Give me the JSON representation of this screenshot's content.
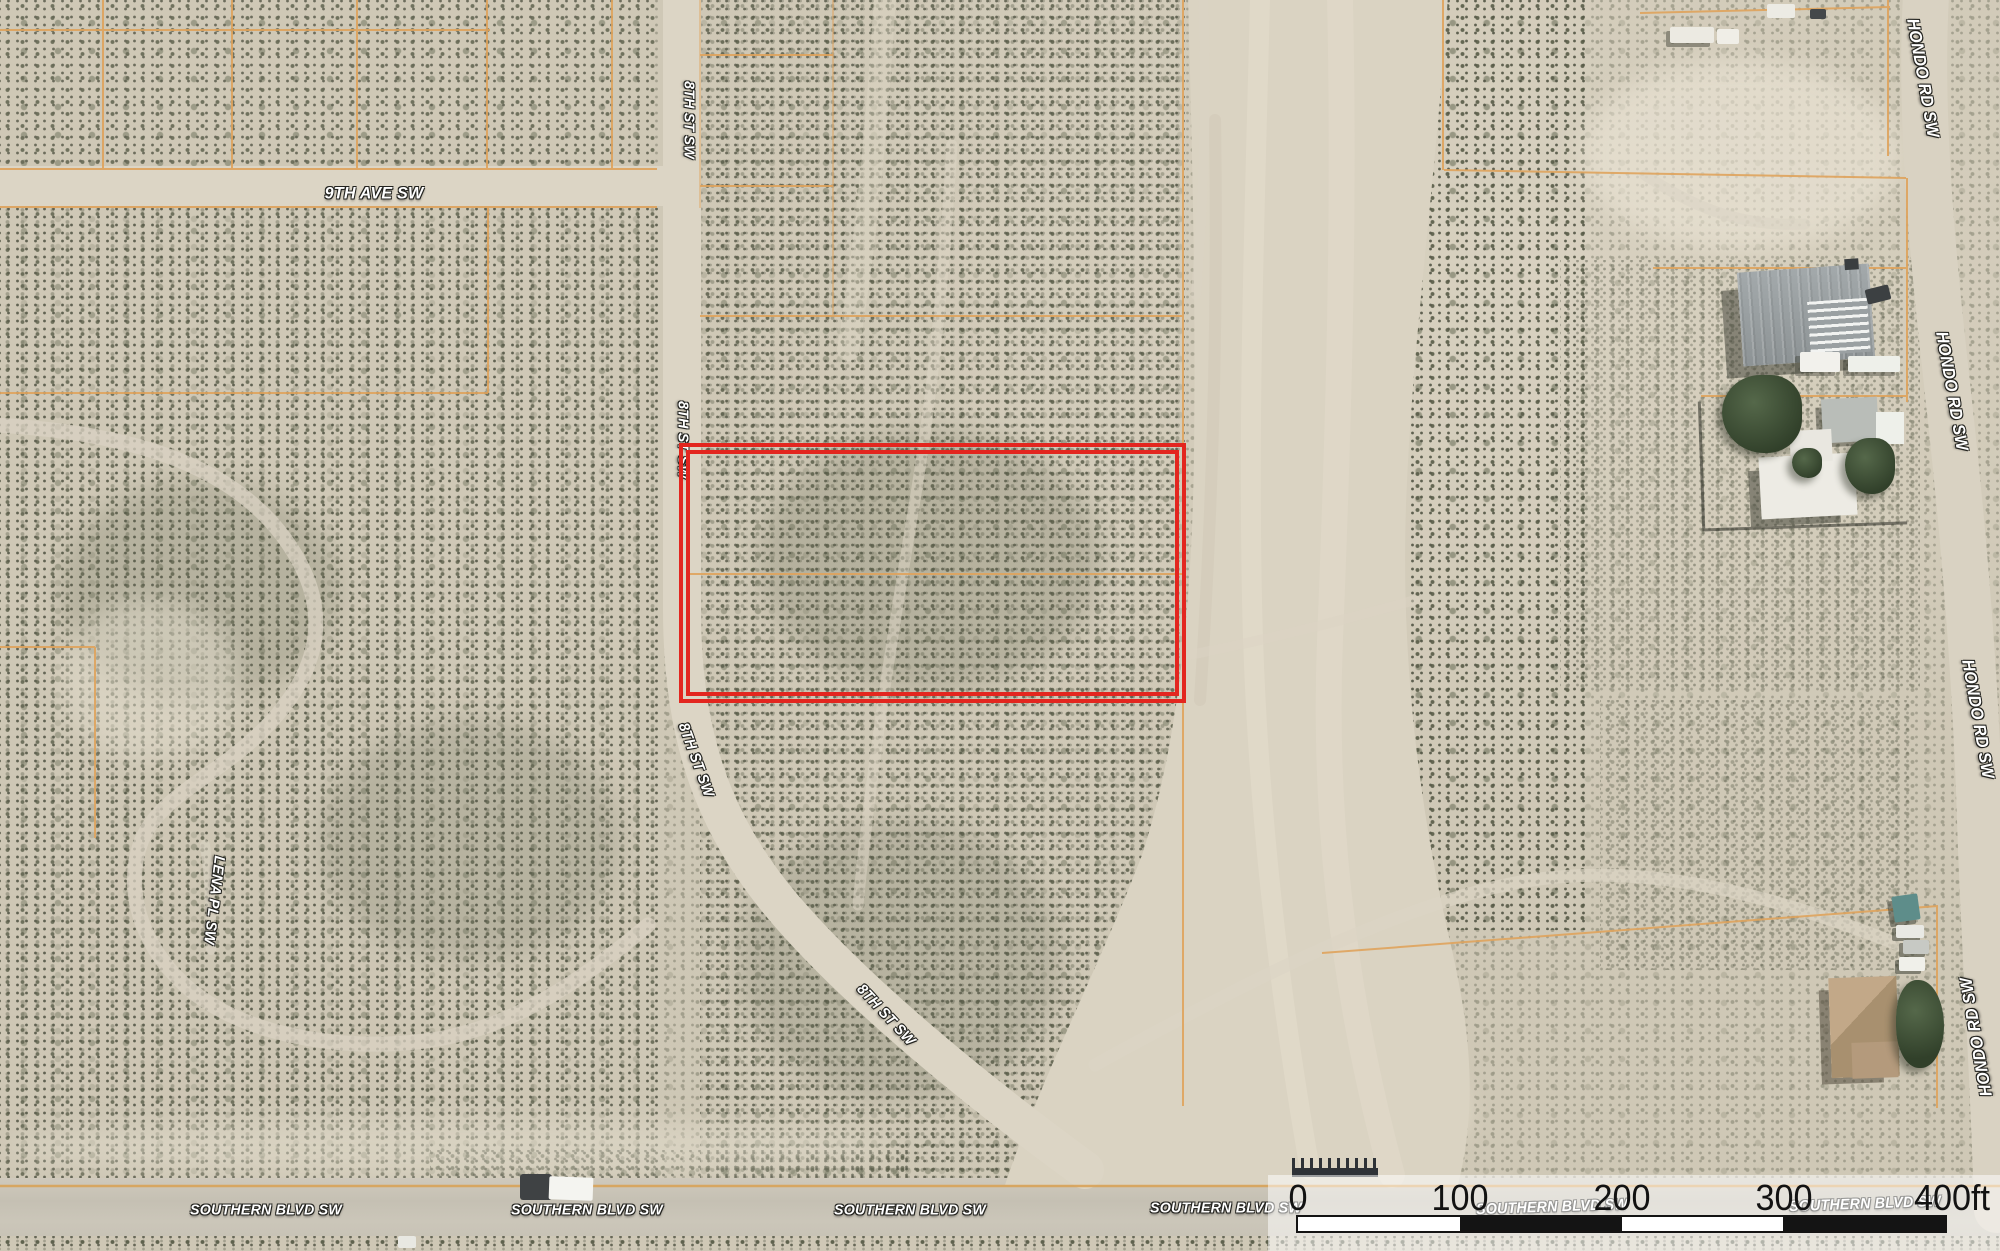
{
  "map": {
    "streets": {
      "ninth_ave": "9TH AVE SW",
      "eighth_st": "8TH ST SW",
      "lena_pl": "LENA PL SW",
      "southern_blvd": "SOUTHERN BLVD SW",
      "hondo_rd": "HONDO RD SW"
    },
    "scale_bar": {
      "ticks": [
        "0",
        "100",
        "200",
        "300",
        "400ft"
      ],
      "unit": "ft",
      "segment_count": 4
    },
    "colors": {
      "parcel_highlight": "#e3261f",
      "parcel_lines": "#dfa35c",
      "scale_text": "#121212",
      "label_text": "#ffffff"
    }
  }
}
